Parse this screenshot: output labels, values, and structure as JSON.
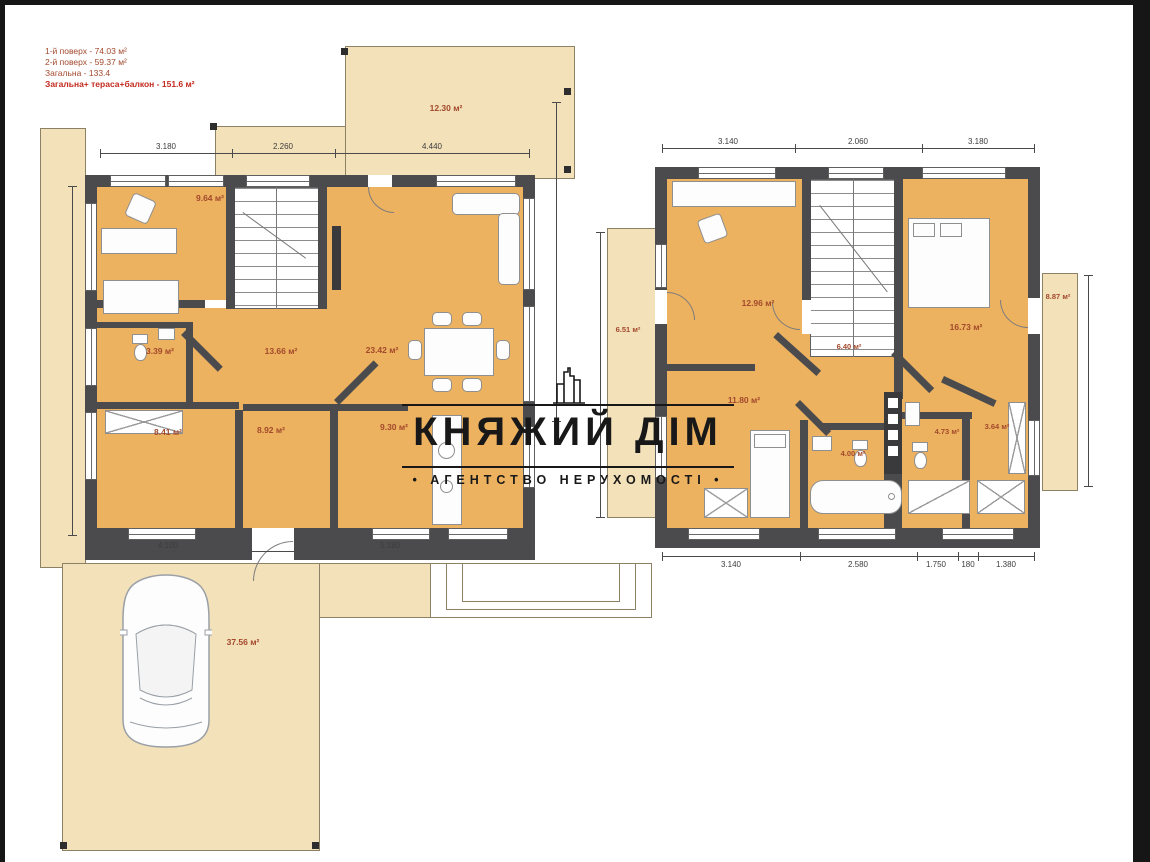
{
  "info": {
    "lines": [
      "1-й поверх - 74.03 м²",
      "2-й поверх - 59.37 м²",
      "Загальна - 133.4",
      "Загальна+ тераса+балкон - 151.6 м²"
    ]
  },
  "watermark": {
    "title": "КНЯЖИЙ ДІМ",
    "subtitle": "• АГЕНТСТВО НЕРУХОМОСТІ •"
  },
  "plan1": {
    "labels": {
      "terrace": "12.30 м²",
      "study": "9.64 м²",
      "wc": "3.39 м²",
      "hall": "13.66 м²",
      "living": "23.42 м²",
      "room_a": "8.41 м²",
      "room_b": "8.92 м²",
      "kitchen": "9.30 м²",
      "driveway": "37.56 м²"
    },
    "dims_top": [
      "3.180",
      "2.260",
      "4.440"
    ],
    "dims_bottom": [
      "4.100",
      "5.180"
    ]
  },
  "plan2": {
    "labels": {
      "balcony_left": "6.51 м²",
      "bedroom_left": "12.96 м²",
      "hall": "6.40 м²",
      "bedroom_right": "16.73 м²",
      "balcony_right": "8.87 м²",
      "bedroom_bottom": "11.80 м²",
      "bathroom": "4.00 м²",
      "wc": "4.73 м²",
      "closet": "3.64 м²"
    },
    "dims_top": [
      "3.140",
      "2.060",
      "3.180"
    ],
    "dims_bottom": [
      "3.140",
      "2.580",
      "1.750",
      "180",
      "1.380"
    ]
  },
  "colors": {
    "room_fill": "#ecb260",
    "outdoor_fill": "#f3e1ba",
    "wall": "#4b4b4d",
    "area_label": "#a3492c",
    "watermark": "#181818"
  }
}
